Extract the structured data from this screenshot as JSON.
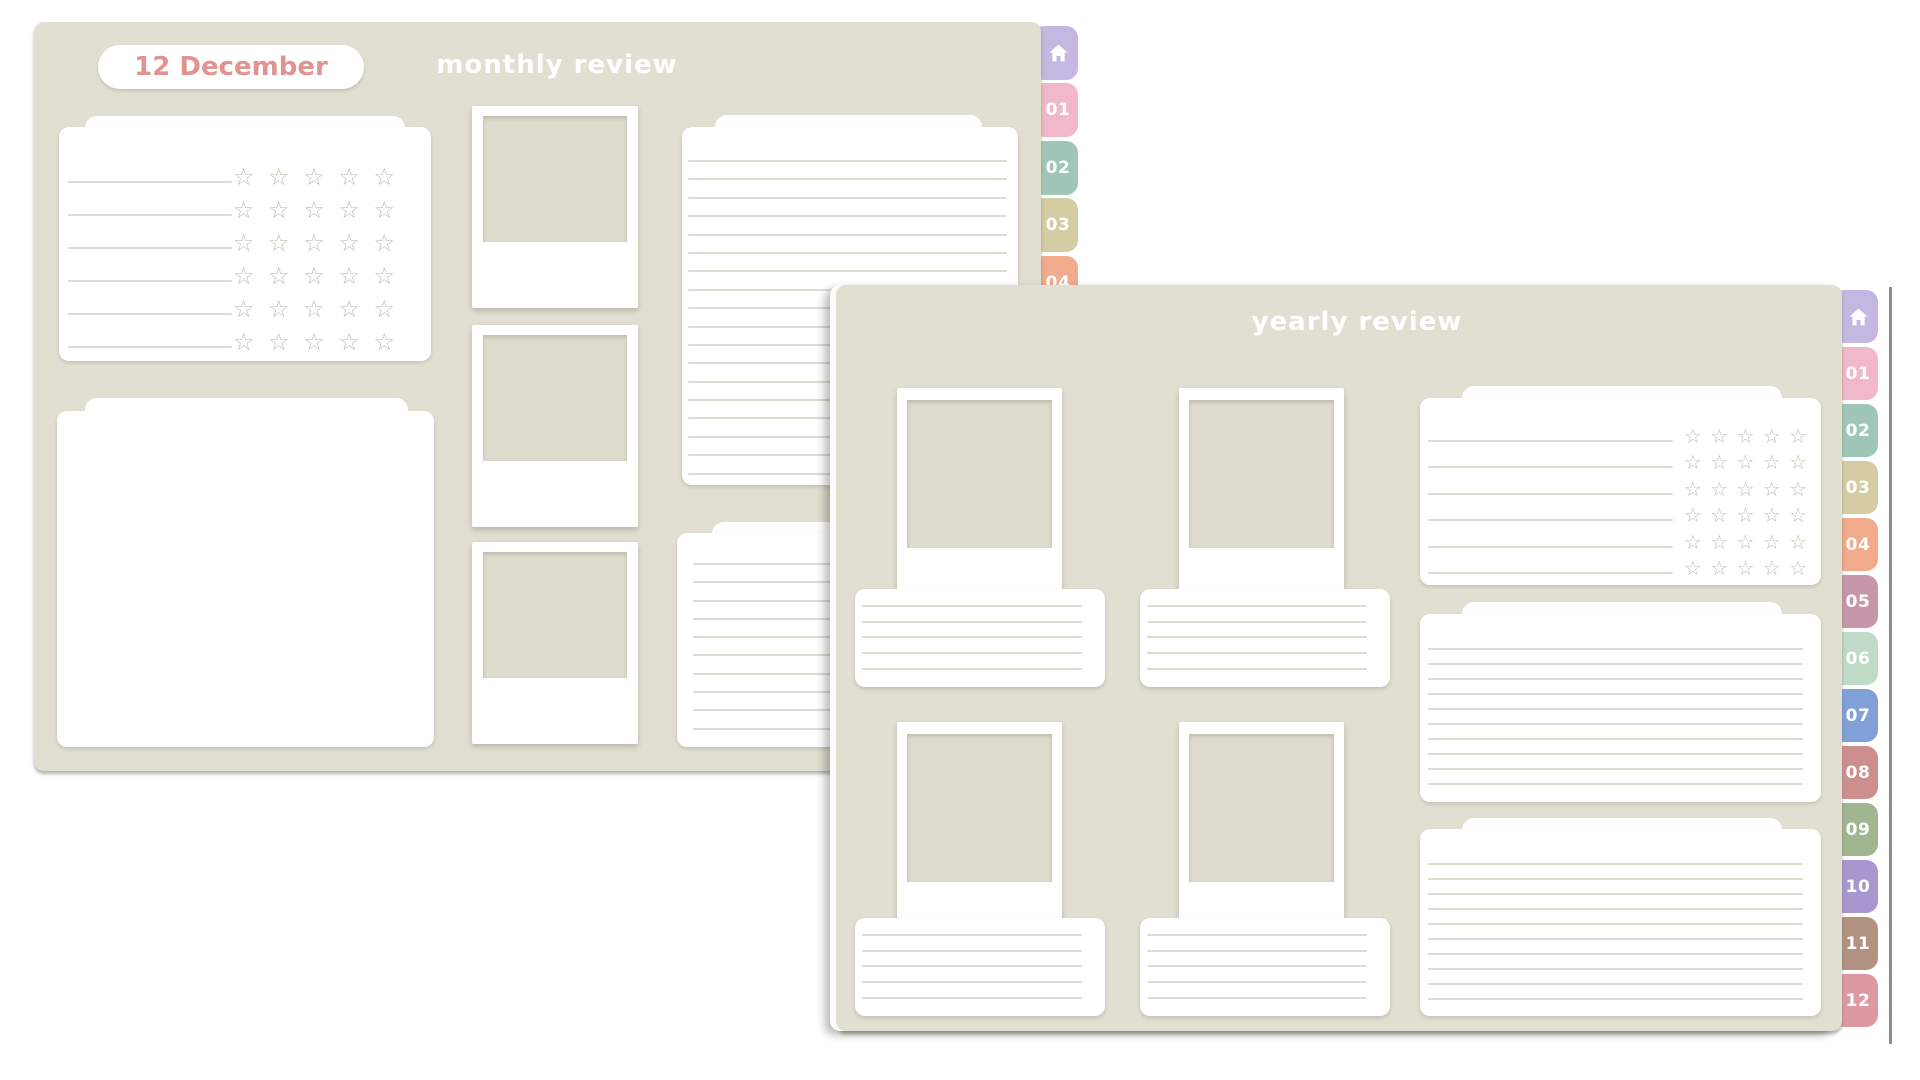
{
  "app": {
    "background_color": "#ffffff",
    "page_color": "#e1dfd1",
    "card_color": "#ffffff",
    "photo_placeholder_color": "#dedccd",
    "rule_color": "#dedbd1",
    "star_color": "#c6c0b2",
    "divider_color": "#8d8d8d"
  },
  "rating": {
    "rows": 6,
    "scale": 5,
    "star_glyph": "☆"
  },
  "tabs": {
    "home": {
      "icon": "home-icon",
      "color": "#c4b8e3"
    },
    "months": [
      {
        "label": "01",
        "color": "#f0b8ca"
      },
      {
        "label": "02",
        "color": "#9fc6b9"
      },
      {
        "label": "03",
        "color": "#d4cca2"
      },
      {
        "label": "04",
        "color": "#f2aa8c"
      },
      {
        "label": "05",
        "color": "#c697a9"
      },
      {
        "label": "06",
        "color": "#bfdac6"
      },
      {
        "label": "07",
        "color": "#82a0d8"
      },
      {
        "label": "08",
        "color": "#cd8f8e"
      },
      {
        "label": "09",
        "color": "#9fb690"
      },
      {
        "label": "10",
        "color": "#a896cf"
      },
      {
        "label": "11",
        "color": "#b29280"
      },
      {
        "label": "12",
        "color": "#dd99a0"
      }
    ]
  },
  "monthly_page": {
    "date_label": "12 December",
    "date_label_color": "#e0938f",
    "title": "monthly review"
  },
  "yearly_page": {
    "title": "yearly review"
  }
}
